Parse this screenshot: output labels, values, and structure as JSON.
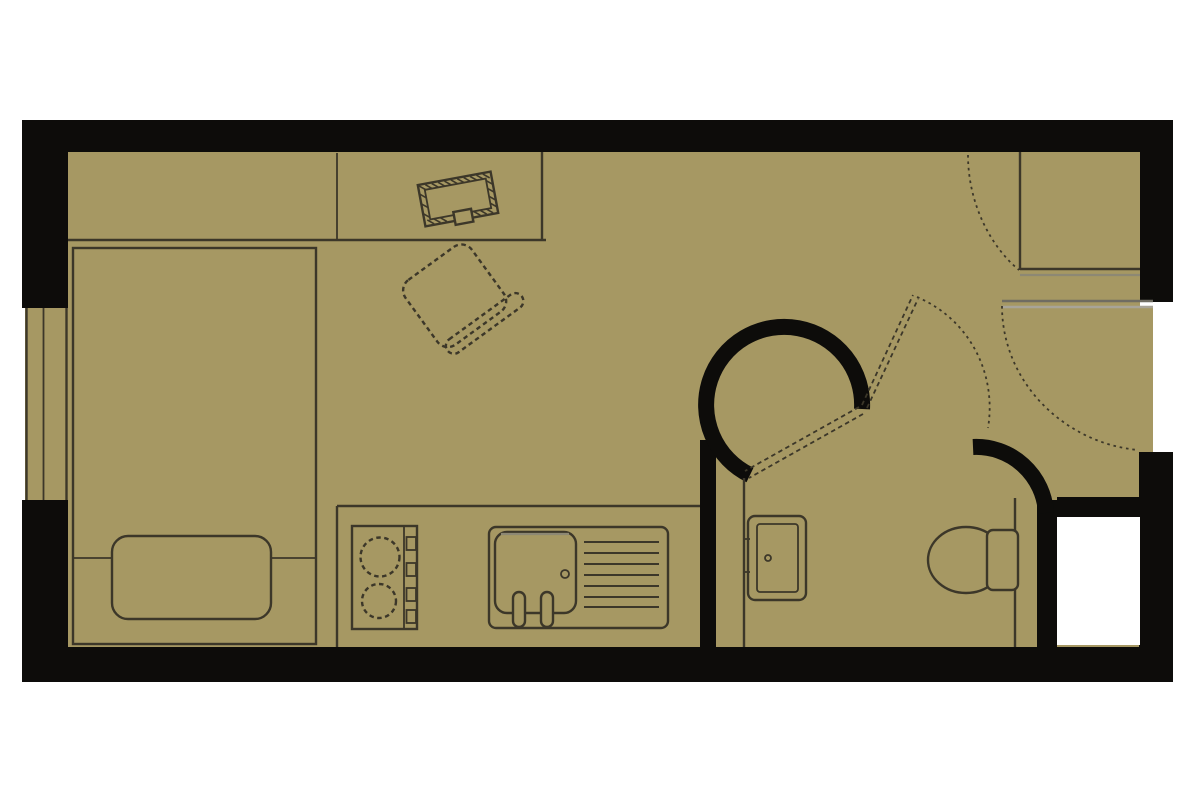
{
  "title": "studio-apartment-floor-plan",
  "canvas": {
    "width": 1200,
    "height": 800
  },
  "colors": {
    "page": "#ffffff",
    "floor": "#a69863",
    "wall": "#0d0c0a",
    "line": "#3c3729",
    "line-soft": "#8d8874",
    "threshold-dark": "#6f6c62",
    "threshold-light": "#a8a498"
  },
  "plan": {
    "type": "studio apartment floor plan",
    "view": "2D top-down architectural drawing",
    "rooms": [
      {
        "name": "main living area",
        "furniture": [
          "single bed",
          "pillow",
          "built-in desk",
          "laptop on desk",
          "desk chair"
        ]
      },
      {
        "name": "kitchenette",
        "furniture": [
          "two-burner hob with control knobs",
          "sink with drainer and taps"
        ]
      },
      {
        "name": "bathroom",
        "furniture": [
          "curved snail shower wall",
          "folding door leaves",
          "wash basin",
          "toilet with cistern"
        ]
      },
      {
        "name": "entrance hall",
        "furniture": [
          "entrance door swing",
          "corner closet with door swing"
        ]
      }
    ],
    "features": [
      "window in left wall",
      "gray entrance threshold",
      "white service void at bottom right"
    ]
  }
}
